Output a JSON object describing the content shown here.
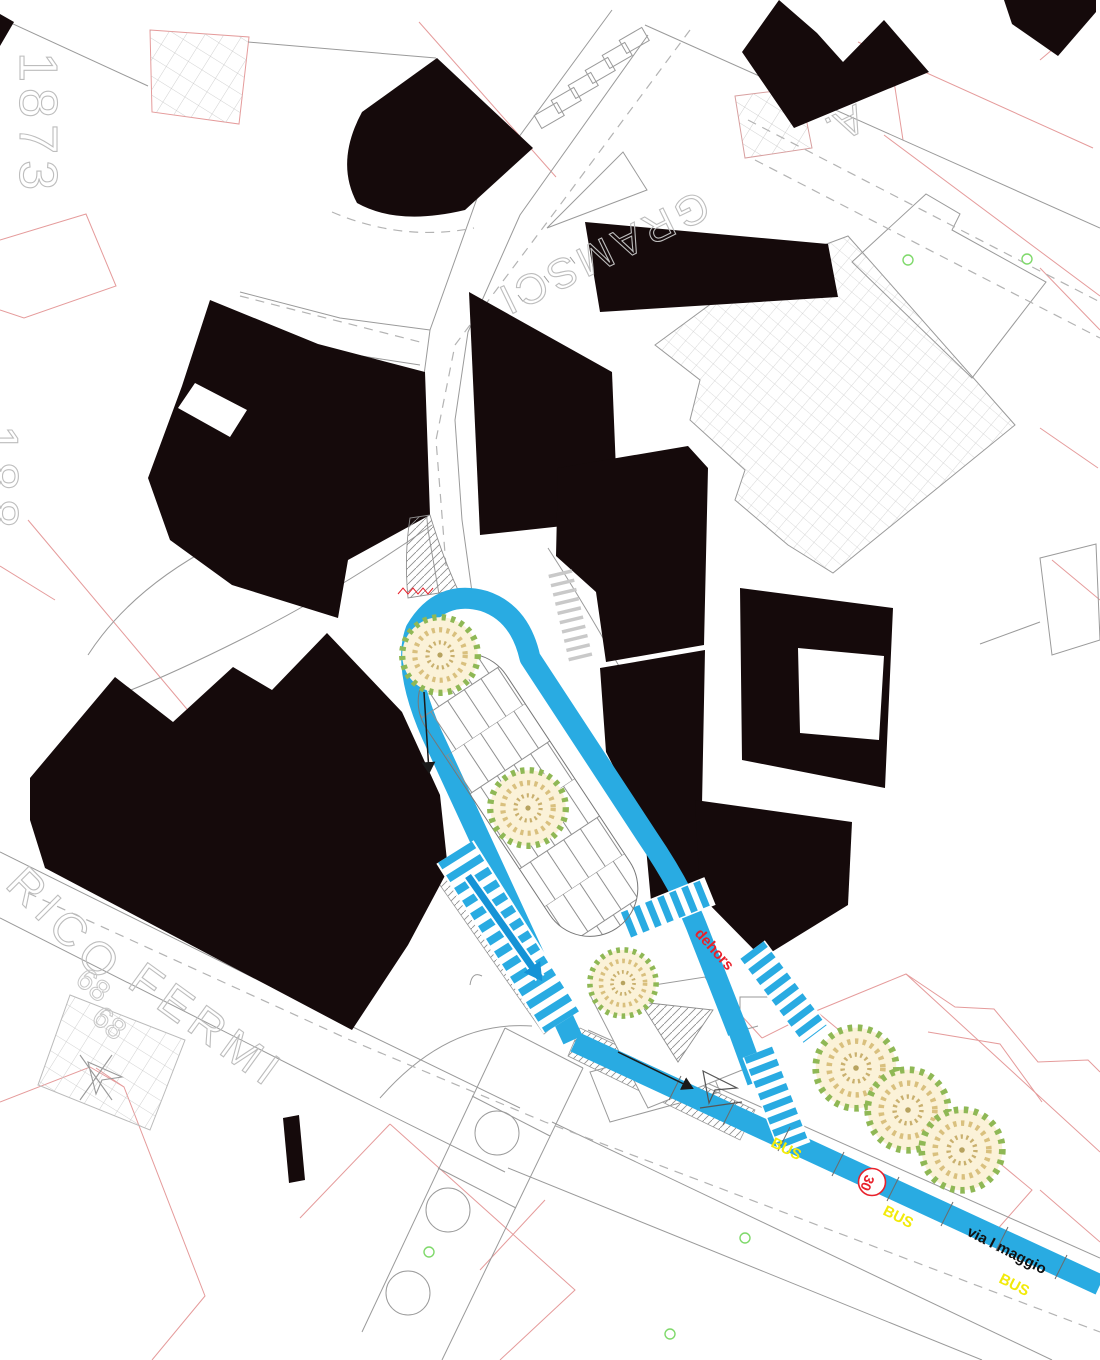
{
  "map": {
    "type": "urban-site-plan",
    "labels": {
      "cadastral_1873": "1873",
      "cadastral_188": "188",
      "street_gramsci": "GRAMSCI",
      "street_gramsci_initial": "A.",
      "street_fermi_prefix": "RICO",
      "street_fermi": "FERMI",
      "house_number_a": "68",
      "house_number_b": "68",
      "dehors": "dehors",
      "speed_limit": "30",
      "bus_1": "BUS",
      "bus_2": "BUS",
      "bus_3": "BUS",
      "street_maggio": "via I maggio"
    },
    "colors": {
      "cycle_lane_blue": "#29ABE2",
      "bus_yellow": "#F2EA0A",
      "sign_red": "#E8212B",
      "building_black": "#150A0B",
      "parcel_pink": "#E59B9B",
      "outline_gray": "#9A9A9A",
      "cad_text_gray": "#BDBDBD",
      "tree_green": "#8FB855",
      "tree_tan": "#D9C07E"
    },
    "symbols": [
      "tree-icon",
      "zebra-crossing",
      "direction-arrow-icon",
      "give-way-arrow-icon",
      "stairs-icon",
      "speed-30-badge"
    ]
  }
}
